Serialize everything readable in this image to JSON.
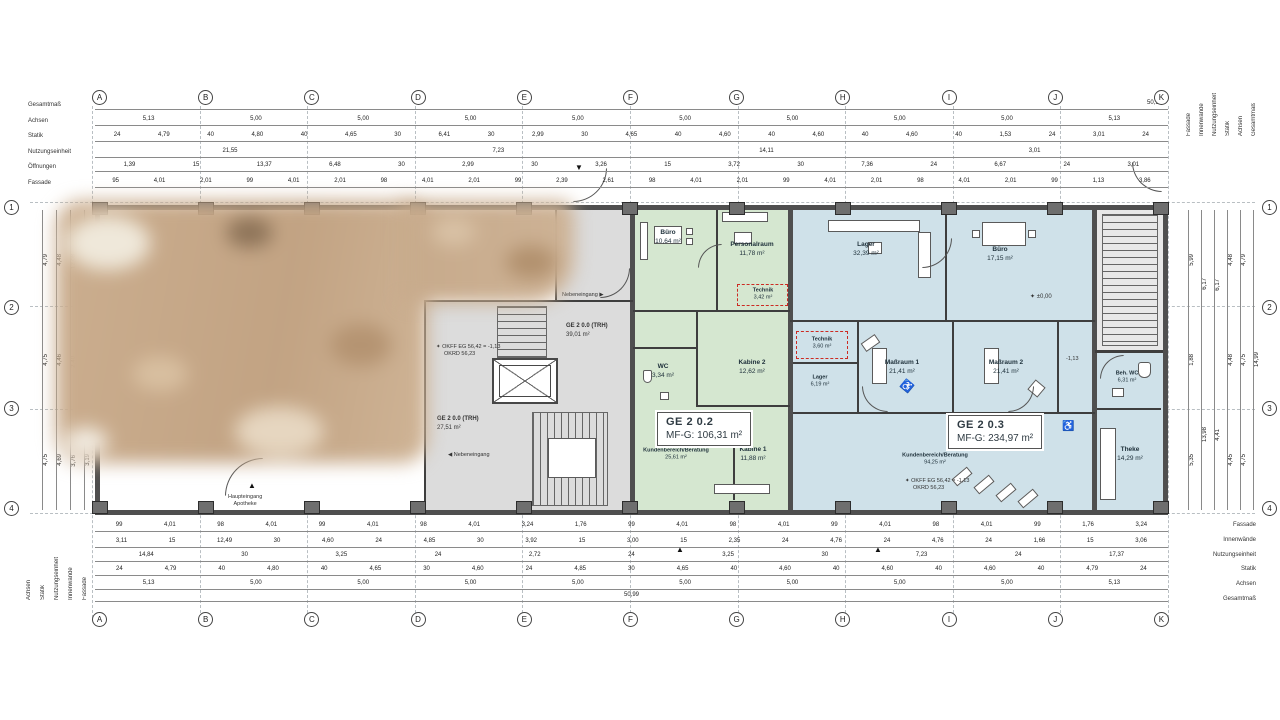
{
  "axes": {
    "letters": [
      "A",
      "B",
      "C",
      "D",
      "E",
      "F",
      "G",
      "H",
      "I",
      "J",
      "K"
    ],
    "numbers": [
      "1",
      "2",
      "3",
      "4"
    ]
  },
  "labels": {
    "left_top": [
      "Gesamtmaß",
      "Achsen",
      "Statik",
      "Nutzungseinheit",
      "Öffnungen",
      "Fassade"
    ],
    "left_bottom": [
      "Achsen",
      "Statik",
      "Nutzungseinheit",
      "Innenwände",
      "Fassade"
    ],
    "right_top": [
      "Fassade",
      "Innenwände",
      "Nutzungseinheit",
      "Statik",
      "Achsen",
      "Gesamtmaß"
    ],
    "right_bottom": [
      "Fassade",
      "Innenwände",
      "Nutzungseinheit",
      "Statik",
      "Achsen",
      "Gesamtmaß"
    ]
  },
  "dims": {
    "top": {
      "gesamt": "50,99",
      "achsen": [
        "5,13",
        "5,00",
        "5,00",
        "5,00",
        "5,00",
        "5,00",
        "5,00",
        "5,00",
        "5,00",
        "5,13"
      ],
      "statik": [
        "24",
        "4,79",
        "40",
        "4,80",
        "40",
        "4,65",
        "30",
        "6,41",
        "30",
        "2,99",
        "30",
        "4,65",
        "40",
        "4,60",
        "40",
        "4,60",
        "40",
        "4,60",
        "40",
        "1,53",
        "24",
        "3,01",
        "24"
      ],
      "nutzung": [
        "21,55",
        "7,23",
        "14,11",
        "3,01"
      ],
      "oeffnungen": [
        "1,39",
        "15",
        "13,37",
        "6,48",
        "30",
        "2,99",
        "30",
        "3,26",
        "15",
        "3,72",
        "30",
        "7,36",
        "24",
        "6,67",
        "24",
        "3,01"
      ],
      "fassade": [
        "95",
        "4,01",
        "2,01",
        "99",
        "4,01",
        "2,01",
        "98",
        "4,01",
        "2,01",
        "99",
        "2,39",
        "2,61",
        "98",
        "4,01",
        "2,01",
        "99",
        "4,01",
        "2,01",
        "98",
        "4,01",
        "2,01",
        "99",
        "1,13",
        "3,86"
      ]
    },
    "bottom": {
      "innen": [
        "99",
        "4,01",
        "98",
        "4,01",
        "99",
        "4,01",
        "98",
        "4,01",
        "3,24",
        "1,76",
        "99",
        "4,01",
        "98",
        "4,01",
        "99",
        "4,01",
        "98",
        "4,01",
        "99",
        "1,76",
        "3,24"
      ],
      "nutzung": [
        "3,11",
        "15",
        "12,49",
        "30",
        "4,60",
        "24",
        "4,85",
        "30",
        "3,92",
        "15",
        "3,00",
        "15",
        "2,35",
        "24",
        "4,76",
        "24",
        "4,76",
        "24",
        "1,66",
        "15",
        "3,06"
      ],
      "nutzung2": [
        "14,84",
        "30",
        "3,25",
        "24",
        "2,72",
        "24",
        "3,25",
        "30",
        "7,23",
        "24",
        "17,37"
      ],
      "statik": [
        "24",
        "4,79",
        "40",
        "4,80",
        "40",
        "4,65",
        "30",
        "4,60",
        "24",
        "4,85",
        "30",
        "4,65",
        "40",
        "4,60",
        "40",
        "4,60",
        "40",
        "4,60",
        "40",
        "4,79",
        "24"
      ],
      "achsen": [
        "5,13",
        "5,00",
        "5,00",
        "5,00",
        "5,00",
        "5,00",
        "5,00",
        "5,00",
        "5,00",
        "5,13"
      ],
      "gesamt": "50,99"
    },
    "left": {
      "achsen": [
        "4,79",
        "4,75",
        "4,75"
      ],
      "statik": [
        "4,48",
        "4,46",
        "4,69"
      ],
      "innen": [
        "12,08",
        "2,40",
        "3,76"
      ],
      "fassade": [
        "5,86",
        "2,85",
        "3,19"
      ]
    },
    "right": {
      "fassade": [
        "5,99",
        "1,88",
        "5,35"
      ],
      "innen": [
        "6,17",
        "13,98"
      ],
      "nutzung": [
        "6,17",
        "4,41"
      ],
      "statik": [
        "4,48",
        "4,48",
        "4,45"
      ],
      "achsen": [
        "4,79",
        "4,75",
        "4,75"
      ],
      "gesamt": "14,99"
    }
  },
  "units": {
    "u1": {
      "id": "GE 2 0.2",
      "area": "MF-G: 106,31 m²"
    },
    "u2": {
      "id": "GE 2 0.3",
      "area": "MF-G: 234,97 m²"
    },
    "trh1": {
      "id": "GE 2 0.0 (TRH)",
      "area": "39,01 m²"
    },
    "trh2": {
      "id": "GE 2 0.0 (TRH)",
      "area": "27,51 m²"
    }
  },
  "rooms": {
    "green": [
      {
        "name": "Büro",
        "area": "10,64 m²"
      },
      {
        "name": "Personalraum",
        "area": "11,78 m²"
      },
      {
        "name": "Technik",
        "area": "3,42 m²"
      },
      {
        "name": "WC",
        "area": "3,34 m²"
      },
      {
        "name": "Kabine 2",
        "area": "12,62 m²"
      },
      {
        "name": "Kabine 1",
        "area": "11,88 m²"
      },
      {
        "name": "Kundenbereich/Beratung",
        "area": "25,61 m²"
      }
    ],
    "blue": [
      {
        "name": "Lager",
        "area": "32,39 m²"
      },
      {
        "name": "Büro",
        "area": "17,15 m²"
      },
      {
        "name": "Technik",
        "area": "3,60 m²"
      },
      {
        "name": "Lager",
        "area": "6,19 m²"
      },
      {
        "name": "Maßraum 1",
        "area": "21,41 m²"
      },
      {
        "name": "Maßraum 2",
        "area": "21,41 m²"
      },
      {
        "name": "Kundenbereich/Beratung",
        "area": "94,25 m²"
      },
      {
        "name": "Beh. WC",
        "area": "6,31 m²"
      },
      {
        "name": "Theke",
        "area": "14,29 m²"
      }
    ]
  },
  "annotations": {
    "nebeneingang": "Nebeneingang",
    "haupteingang_1": "Haupteingang",
    "haupteingang_2": "Apotheke",
    "okff": "OKFF EG 56,42 = -1,13",
    "okrd": "OKRD 56,23",
    "level_zero": "±0,00",
    "level_minus": "-1,13",
    "kaelte": "Kälte",
    "heizung": "Heizung"
  },
  "icons": {
    "level_star": "✦",
    "arrow_right": "▶",
    "arrow_left": "◀",
    "tri_up": "▲",
    "tri_down": "▼",
    "wheelchair": "♿"
  },
  "colors": {
    "unit_green": "#d5e7d0",
    "unit_blue": "#cfe1e9",
    "corridor_gray": "#dcdcdc",
    "wall_dark": "#4f4f4f",
    "accent_red": "#cc2a22"
  }
}
